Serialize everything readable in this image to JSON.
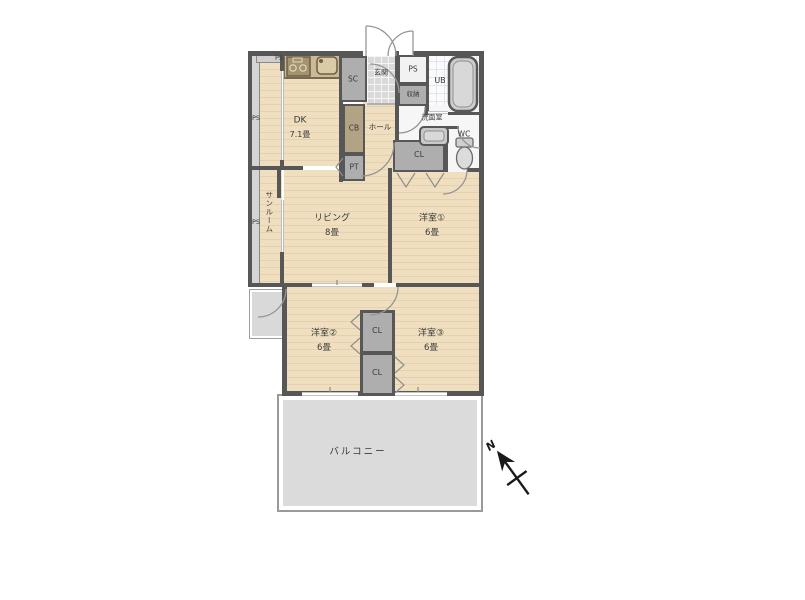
{
  "floorplan": {
    "rooms": {
      "dk": {
        "label": "DK",
        "size": "7.1畳"
      },
      "living": {
        "label": "リビング",
        "size": "8畳"
      },
      "bedroom1": {
        "label": "洋室①",
        "size": "6畳"
      },
      "bedroom2": {
        "label": "洋室②",
        "size": "6畳"
      },
      "bedroom3": {
        "label": "洋室③",
        "size": "6畳"
      },
      "balcony": {
        "label": "バルコニー"
      },
      "sunroom": {
        "label": "サンルーム"
      },
      "entrance": {
        "label": "玄関"
      },
      "hall": {
        "label": "ホール"
      },
      "washroom": {
        "label": "洗面室"
      },
      "toilet": {
        "label": "WC"
      },
      "bath": {
        "label": "UB"
      }
    },
    "storage": {
      "shoe_closet": "SC",
      "closet": "CL",
      "cabinet": "CB",
      "pantry": "PT",
      "shelf": "収納"
    },
    "utility": {
      "pipe_space": "PS"
    },
    "compass": {
      "north": "N"
    },
    "colors": {
      "wall": "#575757",
      "wood_floor": "#efdfc0",
      "kitchen_counter": "#cdb993",
      "gray_storage": "#aeaeae",
      "entrance_tile": "#d9d9d9",
      "balcony": "#dbdbdb",
      "wet_area": "#f6f6f6",
      "text": "#3a3a3a"
    }
  }
}
